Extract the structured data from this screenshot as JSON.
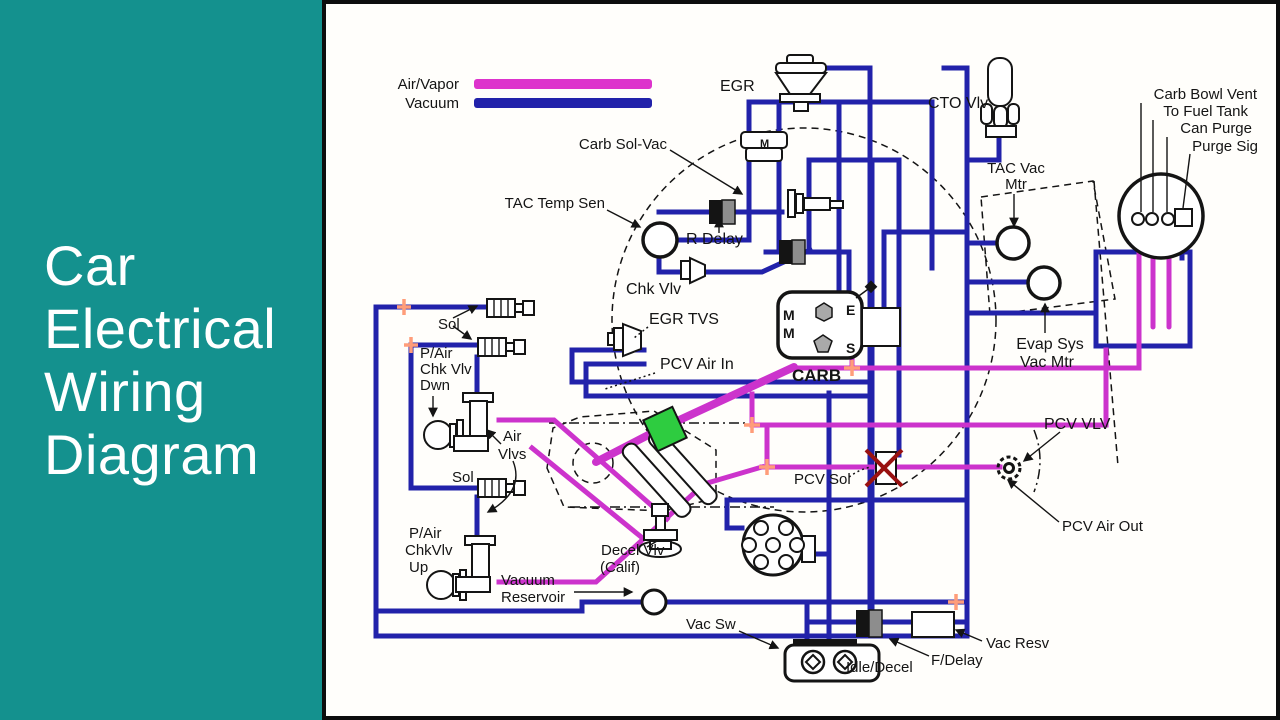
{
  "left_panel": {
    "bg": "#14918e",
    "text_color": "#ffffff",
    "title_lines": [
      "Car",
      "Electrical",
      "Wiring",
      "Diagram"
    ]
  },
  "colors": {
    "air_vapor": "#cc33cc",
    "vacuum": "#2222aa",
    "legend_air_vapor": "#dd33cc",
    "legend_vacuum": "#2222aa",
    "connector_tee": "#ff9d7a",
    "highlight_green": "#2ecc40",
    "alert_red": "#991111"
  },
  "legend": {
    "items": [
      {
        "label": "Air/Vapor",
        "color": "#dd33cc"
      },
      {
        "label": "Vacuum",
        "color": "#2222aa"
      }
    ]
  },
  "carb": {
    "title": "CARB",
    "ports": [
      "M",
      "E",
      "M",
      "S"
    ]
  },
  "labels": [
    {
      "id": "egr",
      "text": "EGR",
      "x": 716,
      "y": 91,
      "anchor": "start",
      "size": 16
    },
    {
      "id": "cto-vlv",
      "text": "CTO Vlv",
      "x": 924,
      "y": 108,
      "anchor": "start",
      "size": 16
    },
    {
      "id": "carb-bowl-vent",
      "text": "Carb Bowl Vent",
      "x": 1253,
      "y": 99,
      "anchor": "end",
      "size": 15
    },
    {
      "id": "to-fuel-tank",
      "text": "To Fuel Tank",
      "x": 1244,
      "y": 116,
      "anchor": "end",
      "size": 15
    },
    {
      "id": "can-purge",
      "text": "Can Purge",
      "x": 1248,
      "y": 133,
      "anchor": "end",
      "size": 15
    },
    {
      "id": "purge-sig",
      "text": "Purge Sig",
      "x": 1254,
      "y": 151,
      "anchor": "end",
      "size": 15
    },
    {
      "id": "tac-vac-mtr-1",
      "text": "TAC Vac",
      "x": 1012,
      "y": 173,
      "anchor": "middle",
      "size": 15
    },
    {
      "id": "tac-vac-mtr-2",
      "text": "Mtr",
      "x": 1012,
      "y": 189,
      "anchor": "middle",
      "size": 15
    },
    {
      "id": "carb-sol-vac",
      "text": "Carb Sol-Vac",
      "x": 663,
      "y": 149,
      "anchor": "end",
      "size": 15
    },
    {
      "id": "tac-temp-sen",
      "text": "TAC Temp Sen",
      "x": 601,
      "y": 208,
      "anchor": "end",
      "size": 15
    },
    {
      "id": "r-delay",
      "text": "R Delay",
      "x": 682,
      "y": 244,
      "anchor": "start",
      "size": 16
    },
    {
      "id": "chk-vlv",
      "text": "Chk Vlv",
      "x": 622,
      "y": 294,
      "anchor": "start",
      "size": 16
    },
    {
      "id": "egr-tvs",
      "text": "EGR TVS",
      "x": 645,
      "y": 324,
      "anchor": "start",
      "size": 16
    },
    {
      "id": "pcv-air-in",
      "text": "PCV Air In",
      "x": 656,
      "y": 369,
      "anchor": "start",
      "size": 16
    },
    {
      "id": "evap-sys-vac-mtr-1",
      "text": "Evap Sys",
      "x": 1046,
      "y": 349,
      "anchor": "middle",
      "size": 16
    },
    {
      "id": "evap-sys-vac-mtr-2",
      "text": "Vac Mtr",
      "x": 1043,
      "y": 367,
      "anchor": "middle",
      "size": 16
    },
    {
      "id": "pcv-vlv",
      "text": "PCV VLV",
      "x": 1040,
      "y": 429,
      "anchor": "start",
      "size": 16
    },
    {
      "id": "pcv-air-out",
      "text": "PCV Air Out",
      "x": 1058,
      "y": 531,
      "anchor": "start",
      "size": 15
    },
    {
      "id": "pcv-sol",
      "text": "PCV Sol",
      "x": 790,
      "y": 484,
      "anchor": "start",
      "size": 15
    },
    {
      "id": "sol-upper",
      "text": "Sol",
      "x": 434,
      "y": 329,
      "anchor": "start",
      "size": 15
    },
    {
      "id": "pair-chk-vlv-dwn-1",
      "text": "P/Air",
      "x": 416,
      "y": 358,
      "anchor": "start",
      "size": 15
    },
    {
      "id": "pair-chk-vlv-dwn-2",
      "text": "Chk Vlv",
      "x": 416,
      "y": 374,
      "anchor": "start",
      "size": 15
    },
    {
      "id": "pair-chk-vlv-dwn-3",
      "text": "Dwn",
      "x": 416,
      "y": 390,
      "anchor": "start",
      "size": 15
    },
    {
      "id": "air-vlvs-1",
      "text": "Air",
      "x": 499,
      "y": 441,
      "anchor": "start",
      "size": 15
    },
    {
      "id": "air-vlvs-2",
      "text": "Vlvs",
      "x": 494,
      "y": 459,
      "anchor": "start",
      "size": 15
    },
    {
      "id": "sol-lower",
      "text": "Sol",
      "x": 448,
      "y": 482,
      "anchor": "start",
      "size": 15
    },
    {
      "id": "pair-chkvlv-up-1",
      "text": "P/Air",
      "x": 405,
      "y": 538,
      "anchor": "start",
      "size": 15
    },
    {
      "id": "pair-chkvlv-up-2",
      "text": "ChkVlv",
      "x": 401,
      "y": 555,
      "anchor": "start",
      "size": 15
    },
    {
      "id": "pair-chkvlv-up-3",
      "text": "Up",
      "x": 405,
      "y": 572,
      "anchor": "start",
      "size": 15
    },
    {
      "id": "vacuum-reservoir-1",
      "text": "Vacuum",
      "x": 497,
      "y": 585,
      "anchor": "start",
      "size": 15
    },
    {
      "id": "vacuum-reservoir-2",
      "text": "Reservoir",
      "x": 497,
      "y": 602,
      "anchor": "start",
      "size": 15
    },
    {
      "id": "decel-vlv-1",
      "text": "Decel Vlv",
      "x": 597,
      "y": 555,
      "anchor": "start",
      "size": 15
    },
    {
      "id": "decel-vlv-2",
      "text": "(Calif)",
      "x": 596,
      "y": 572,
      "anchor": "start",
      "size": 15
    },
    {
      "id": "vac-sw",
      "text": "Vac Sw",
      "x": 682,
      "y": 629,
      "anchor": "start",
      "size": 15
    },
    {
      "id": "idle-decel",
      "text": "Idle/Decel",
      "x": 842,
      "y": 672,
      "anchor": "start",
      "size": 15
    },
    {
      "id": "f-delay",
      "text": "F/Delay",
      "x": 927,
      "y": 665,
      "anchor": "start",
      "size": 15
    },
    {
      "id": "vac-resv",
      "text": "Vac Resv",
      "x": 982,
      "y": 648,
      "anchor": "start",
      "size": 15
    },
    {
      "id": "carb-port-m1",
      "text": "M",
      "x": 779,
      "y": 320,
      "anchor": "start",
      "size": 14,
      "bold": true
    },
    {
      "id": "carb-port-e",
      "text": "E",
      "x": 842,
      "y": 315,
      "anchor": "start",
      "size": 14,
      "bold": true
    },
    {
      "id": "carb-port-m2",
      "text": "M",
      "x": 779,
      "y": 338,
      "anchor": "start",
      "size": 14,
      "bold": true
    },
    {
      "id": "carb-port-s",
      "text": "S",
      "x": 842,
      "y": 353,
      "anchor": "start",
      "size": 14,
      "bold": true
    },
    {
      "id": "carb-title",
      "text": "CARB",
      "x": 788,
      "y": 381,
      "anchor": "start",
      "size": 17,
      "bold": true
    },
    {
      "id": "carb-sol-vac-m",
      "text": "M",
      "x": 756,
      "y": 147,
      "anchor": "start",
      "size": 11,
      "bold": true
    }
  ]
}
